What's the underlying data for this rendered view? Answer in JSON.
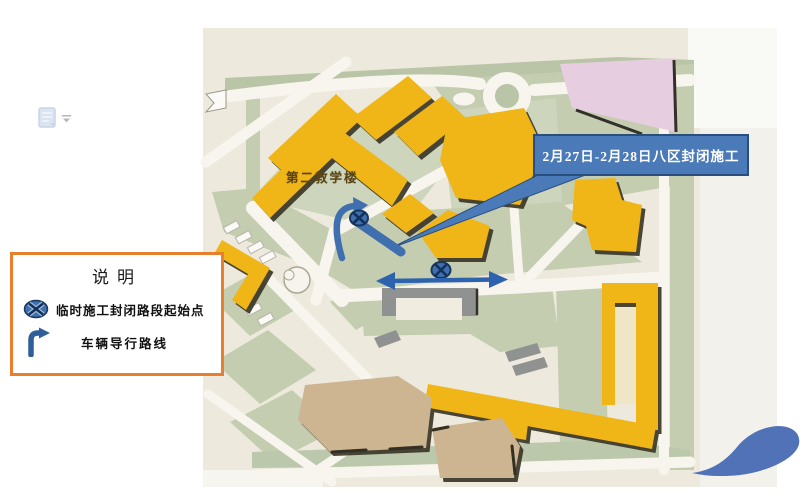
{
  "page": {
    "background": "#ffffff"
  },
  "toolbar": {
    "paste_options_icon": "clipboard-document",
    "dropdown_glyph": "▾"
  },
  "legend": {
    "title": "说明",
    "border_color": "#e87f2e",
    "items": [
      {
        "icon": "closure-point-icon",
        "label": "临时施工封闭路段起始点"
      },
      {
        "icon": "diversion-route-icon",
        "label": "车辆导行路线"
      }
    ]
  },
  "callout": {
    "text": "2月27日-2月28日八区封闭施工",
    "fill": "#4a7ab8",
    "border": "#2a4e7e",
    "text_color": "#ffffff"
  },
  "map": {
    "building_label": "第二教学楼",
    "annotations": {
      "closure_points": 2,
      "closed_segment_marker": "thick-blue-bar",
      "diversion_arrow": "u-turn-arrow",
      "two_way_arrow": "horizontal-double-arrow"
    },
    "colors": {
      "photo_bg": "#edeadd",
      "lawn_green": "#c4cdb0",
      "road_white": "#f7f5ee",
      "building_yellow": "#f0b517",
      "building_shadow": "#3b3728",
      "pink_building": "#e7cde0",
      "gray_building": "#909292",
      "tan_building": "#cdb592",
      "annotation_blue": "#3f6fae",
      "arrow_blue": "#2d62ae"
    }
  }
}
